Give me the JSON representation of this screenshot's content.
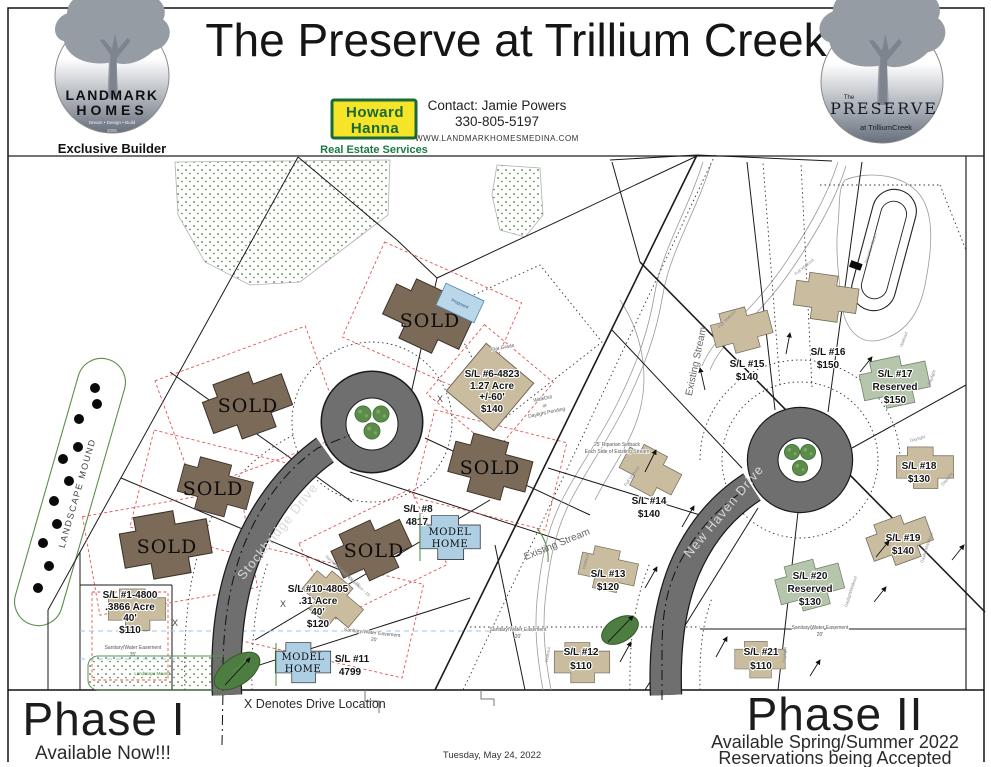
{
  "header": {
    "title": "The Preserve at Trillium Creek",
    "landmark": {
      "line1": "LANDMARK",
      "line2": "HOMES",
      "tagline": "Dream • Design • Build",
      "year": "2006",
      "caption": "Exclusive Builder"
    },
    "hanna": {
      "word1": "Howard",
      "word2": "Hanna",
      "caption": "Real Estate Services"
    },
    "contact": {
      "name": "Contact: Jamie Powers",
      "phone": "330-805-5197",
      "website": "WWW.LANDMARKHOMESMEDINA.COM"
    },
    "preserve": {
      "the": "The",
      "name": "PRESERVE",
      "sub": "at TrilliumCreek"
    }
  },
  "map": {
    "phase1": {
      "name": "Phase I",
      "availability": "Available Now!!!",
      "road": "Stockbridge Drive",
      "mound": "LANDSCAPE MOUND",
      "mound_small": "Landscape Mound",
      "drive_note": "X Denotes Drive Location",
      "x": "X",
      "sold": "SOLD",
      "model_line1": "MODEL",
      "model_line2": "HOME",
      "proposed": "Proposed",
      "easement35": {
        "label": "Sanitary/Water Easement",
        "size": "35'"
      },
      "easement20": {
        "label": "Sanitary/Water Easement",
        "size": "20'"
      },
      "easement15": "Sanitary Easement - 15'",
      "lots": {
        "lot1": {
          "id": "S/L #1-4800",
          "acreage": ".3866 Acre",
          "frontage": "40'",
          "price": "$110"
        },
        "lot6": {
          "id": "S/L #6-4823",
          "acreage": "1.27 Acre",
          "frontage": "+/-60'",
          "price": "$140",
          "grade": "Flat Grade",
          "note1": "WalkOut",
          "note2": "or",
          "note3": "Daylight Pending"
        },
        "lot8": {
          "id": "S/L #8",
          "address": "4817"
        },
        "lot10": {
          "id": "S/L #10-4805",
          "acreage": ".31 Acre",
          "frontage": "40'",
          "price": "$120"
        },
        "lot11": {
          "id": "S/L #11",
          "address": "4799"
        }
      }
    },
    "phase2": {
      "name": "Phase II",
      "availability": "Available Spring/Summer 2022",
      "reservations": "Reservations being Accepted",
      "road": "New Haven Drive",
      "stream": "Existing Stream",
      "basin": "Retention Basin",
      "riparian": {
        "line1": "25' Riparian Setback",
        "line2": "Each Side of Existing Stream"
      },
      "easement20": {
        "label": "Sanitary/Water Easement",
        "size": "20'"
      },
      "types": {
        "full_walkout": "Full Walkout",
        "walkout": "Walkout",
        "daylight": "Daylight",
        "daylight_walkout": "Daylight/Walkout"
      },
      "lots": {
        "lot12": {
          "id": "S/L #12",
          "price": "$110"
        },
        "lot13": {
          "id": "S/L #13",
          "price": "$120"
        },
        "lot14": {
          "id": "S/L #14",
          "price": "$140"
        },
        "lot15": {
          "id": "S/L #15",
          "price": "$140"
        },
        "lot16": {
          "id": "S/L #16",
          "price": "$150"
        },
        "lot17": {
          "id": "S/L #17",
          "reserved": "Reserved",
          "price": "$150"
        },
        "lot18": {
          "id": "S/L #18",
          "price": "$130"
        },
        "lot19": {
          "id": "S/L #19",
          "price": "$140"
        },
        "lot20": {
          "id": "S/L #20",
          "reserved": "Reserved",
          "price": "$130"
        },
        "lot21": {
          "id": "S/L #21",
          "price": "$110"
        }
      }
    },
    "date": "Tuesday, May 24, 2022"
  },
  "colors": {
    "road": "#6f6f6f",
    "sold": "#7b6a57",
    "available": "#c9bc9f",
    "reserved": "#b5c6ad",
    "model": "#aecfe3",
    "hanna_yellow": "#f5e427",
    "hanna_green": "#186a38",
    "tree": "#5b8c4a"
  }
}
